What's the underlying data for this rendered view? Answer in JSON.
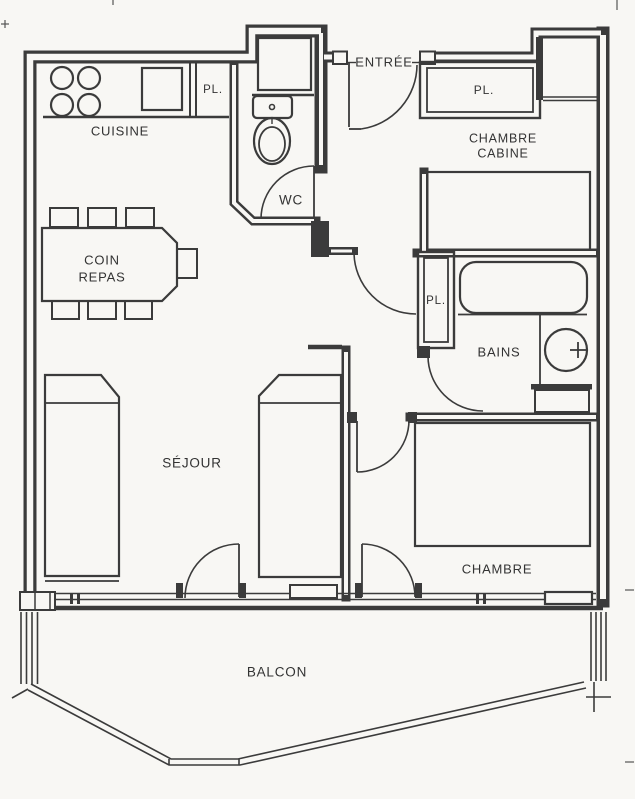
{
  "labels": {
    "entree": "ENTRÉE",
    "cuisine": "CUISINE",
    "pl_cuisine": "PL.",
    "wc": "WC",
    "chambre_cabine_1": "CHAMBRE",
    "chambre_cabine_2": "CABINE",
    "pl_cabine": "PL.",
    "coin_repas_1": "COIN",
    "coin_repas_2": "REPAS",
    "pl_bains": "PL.",
    "bains": "BAINS",
    "sejour": "SÉJOUR",
    "chambre": "CHAMBRE",
    "balcon": "BALCON"
  },
  "colors": {
    "line": "#3b3b3b",
    "paper": "#f8f7f4",
    "text": "#333333"
  }
}
